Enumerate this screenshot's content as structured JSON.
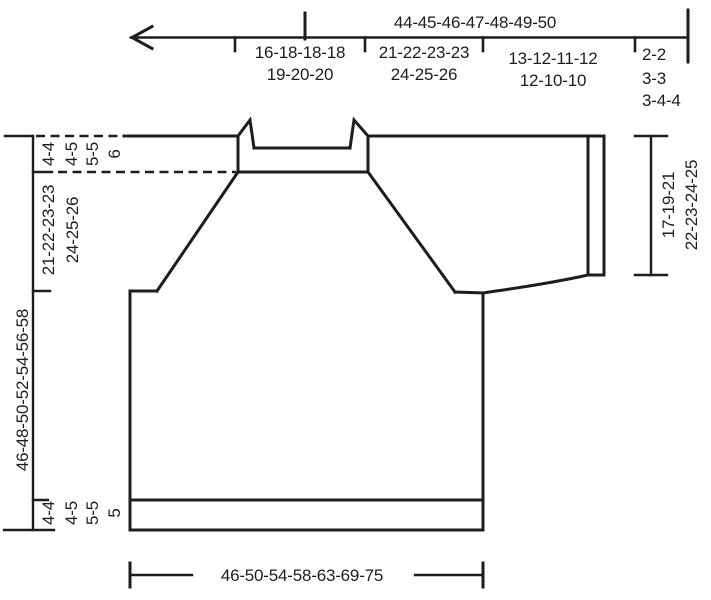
{
  "diagram_type": "knitting-pattern-schematic",
  "colors": {
    "ink": "#1d1d1b",
    "background": "#ffffff"
  },
  "top_arrow": {
    "total": "44-45-46-47-48-49-50",
    "segments": [
      {
        "rows": [
          "16-18-18-18",
          "19-20-20"
        ]
      },
      {
        "rows": [
          "21-22-23-23",
          "24-25-26"
        ]
      },
      {
        "rows": [
          "13-12-11-12",
          "12-10-10"
        ]
      },
      {
        "rows": [
          "2-2",
          "3-3",
          "3-4-4"
        ]
      }
    ]
  },
  "left_measurements": {
    "neck_depth_parts": [
      "4-4",
      "4-5",
      "5-5",
      "6"
    ],
    "raglan_depth_parts": [
      "21-22-23-23",
      "24-25-26"
    ],
    "total_length": "46-48-50-52-54-56-58",
    "bottom_rib_parts": [
      "4-4",
      "4-5",
      "5-5",
      "5"
    ]
  },
  "right_measurement": {
    "sleeve_parts": [
      "17-19-21",
      "22-23-24-25"
    ]
  },
  "bottom_measurement": {
    "width": "46-50-54-58-63-69-75"
  }
}
